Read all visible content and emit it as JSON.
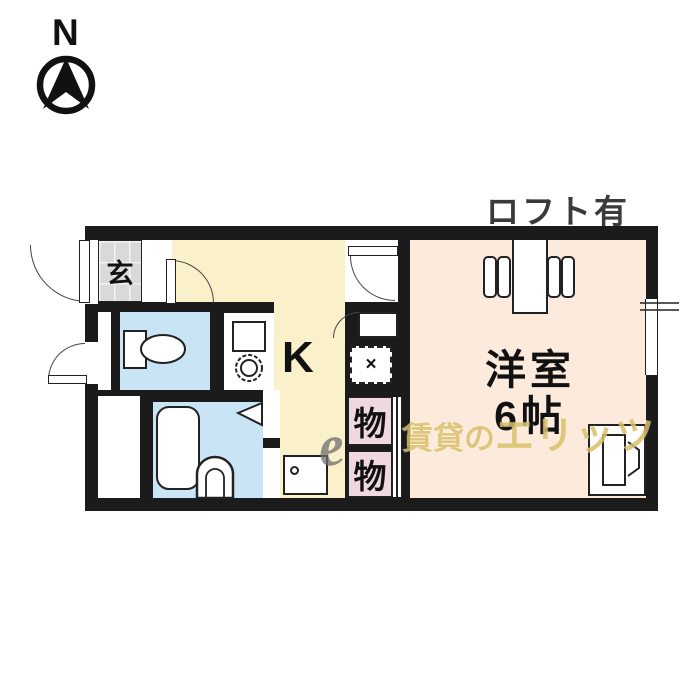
{
  "compass": {
    "label": "N",
    "icon": "north-compass-icon"
  },
  "notes": {
    "loft": "ロフト有"
  },
  "rooms": {
    "entrance": {
      "label": "玄"
    },
    "kitchen": {
      "label": "K"
    },
    "western_room": {
      "label": "洋室",
      "size": "6帖"
    },
    "storage_upper": {
      "label": "物"
    },
    "storage_lower": {
      "label": "物"
    }
  },
  "fixtures": {
    "toilet": "toilet-icon",
    "bathtub": "bathtub-icon",
    "washbasin": "washbasin-icon",
    "kitchen_sink": "sink-icon",
    "stove_burner": "burner-icon",
    "water_heater": "water-heater-icon",
    "loft_ladder": "ladder-icon",
    "appliance": "washing-machine-icon",
    "vent_hatch": "vent-hatch-icon",
    "vent_mark": "×"
  },
  "watermark": {
    "logo": "e",
    "text_small": "賃貸の",
    "text_big": "エリッツ"
  },
  "colors": {
    "wall": "#1b1b1b",
    "kitchen": "#faf0c9",
    "western": "#fcebdc",
    "water": "#c9e4f4",
    "storage": "#f0d8e2",
    "genkan": "#d9d9d9",
    "watermark": "#d9c06a"
  }
}
